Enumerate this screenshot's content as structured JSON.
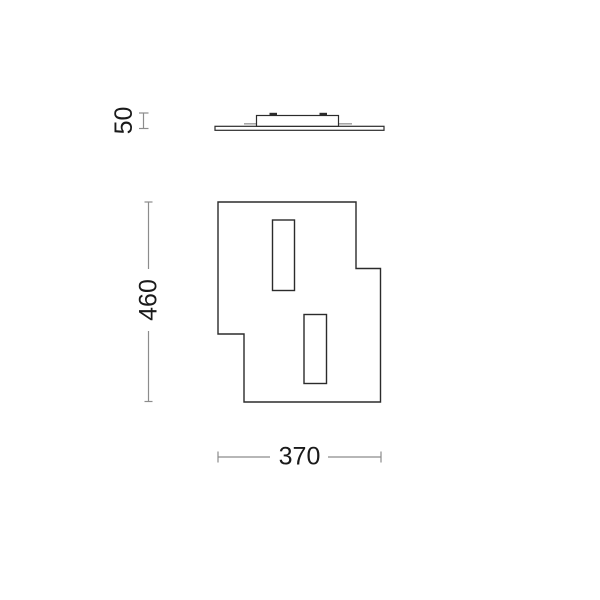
{
  "drawing": {
    "labels": {
      "profile_height": "50",
      "front_height": "460",
      "front_width": "370"
    },
    "colors": {
      "outline": "#2b2b2b",
      "dimension": "#8c8c8c",
      "text": "#1a1a1a",
      "background": "#ffffff"
    }
  }
}
